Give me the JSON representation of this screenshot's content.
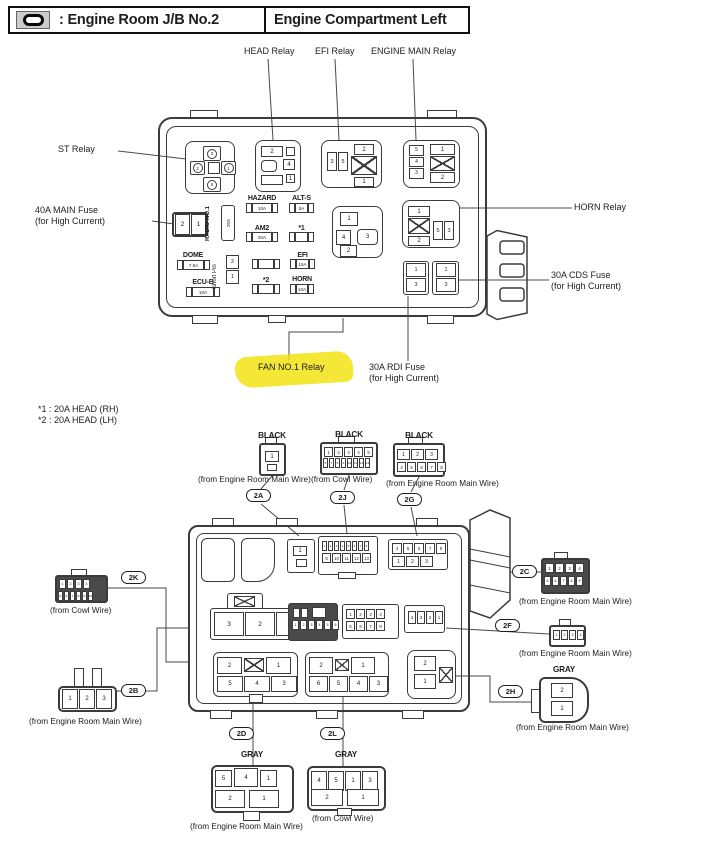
{
  "colors": {
    "highlight": "#f1e20a",
    "ink": "#3b3b3b"
  },
  "header": {
    "legend": ": Engine Room J/B No.2",
    "location": "Engine Compartment Left"
  },
  "notes": [
    "*1 : 20A HEAD (RH)",
    "*2 : 20A HEAD (LH)"
  ],
  "top": {
    "callouts": {
      "head": "HEAD Relay",
      "efi": "EFI Relay",
      "engine_main": "ENGINE MAIN Relay",
      "st": "ST Relay",
      "horn": "HORN Relay",
      "fan": "FAN NO.1 Relay",
      "main_fuse": [
        "40A MAIN Fuse",
        "(for High Current)"
      ],
      "cds_fuse": [
        "30A CDS Fuse",
        "(for High Current)"
      ],
      "rdi_fuse": [
        "30A RDI Fuse",
        "(for High Current)"
      ]
    },
    "fuses": {
      "hazard": {
        "label": "HAZARD",
        "rating": "10A"
      },
      "alt_s": {
        "label": "ALT-S",
        "rating": "5A"
      },
      "am2": {
        "label": "AM2",
        "rating": "30A"
      },
      "star1": {
        "label": "*1",
        "rating": ""
      },
      "dome": {
        "label": "DOME",
        "rating": "7.5A"
      },
      "efi": {
        "label": "EFI",
        "rating": "15A"
      },
      "ecu_b": {
        "label": "ECU-B",
        "rating": "10A"
      },
      "star2": {
        "label": "*2",
        "rating": ""
      },
      "horn": {
        "label": "HORN",
        "rating": "10A"
      },
      "radio": {
        "label": "RADIO NO.1",
        "rating": "20A"
      },
      "short_pin": {
        "label": "Short Pin",
        "pins": [
          "2",
          "1"
        ]
      }
    },
    "relays": {
      "st": {
        "top": "3",
        "left": "2",
        "right": "1",
        "bottom": "5"
      },
      "head": {
        "c1": "2",
        "c2": "4",
        "c3": "1"
      },
      "efi": {
        "pair": [
          "3",
          "5"
        ],
        "top": "2",
        "bottom": "1"
      },
      "engine_main": {
        "col": [
          "5",
          "4",
          "3"
        ],
        "top": "1",
        "bottom": "2"
      },
      "horn": {
        "top": "1",
        "bottom": "2",
        "pair": [
          "5",
          "3"
        ]
      },
      "fan": {
        "top": "1",
        "left": "4",
        "right": "3",
        "bottom": "2"
      },
      "main_fuse_cells": [
        "2",
        "1"
      ],
      "rdi_cells": [
        "1",
        "3"
      ],
      "cds_cells": [
        "1",
        "3"
      ]
    }
  },
  "bottom": {
    "c2a": {
      "id": "2A",
      "color": "BLACK",
      "from": "(from Engine Room Main Wire)"
    },
    "c2j": {
      "id": "2J",
      "color": "BLACK",
      "from": "(from Cowl Wire)"
    },
    "c2g": {
      "id": "2G",
      "color": "BLACK",
      "from": "(from Engine Room Main Wire)"
    },
    "c2k": {
      "id": "2K",
      "from": "(from Cowl Wire)"
    },
    "c2b": {
      "id": "2B",
      "from": "(from Engine Room Main Wire)"
    },
    "c2c": {
      "id": "2C",
      "from": "(from Engine Room Main Wire)"
    },
    "c2f": {
      "id": "2F",
      "from": "(from Engine Room Main Wire)"
    },
    "c2h": {
      "id": "2H",
      "color": "GRAY",
      "from": "(from Engine Room Main Wire)"
    },
    "c2d": {
      "id": "2D",
      "color": "GRAY",
      "from": "(from Engine Room Main Wire)"
    },
    "c2l": {
      "id": "2L",
      "color": "GRAY",
      "from": "(from Cowl Wire)"
    },
    "pins": {
      "p2a": [
        "1"
      ],
      "p2j_r1": [
        "1",
        "2",
        "3",
        "4",
        "5"
      ],
      "p2j_r2": [
        "6",
        "7",
        "8",
        "9",
        "10",
        "11",
        "12",
        "13"
      ],
      "p2g_r1": [
        "1",
        "2",
        "3"
      ],
      "p2g_r2": [
        "4",
        "5",
        "6",
        "7",
        "8"
      ],
      "p2k_r1": [
        "1",
        "2",
        "3",
        "4"
      ],
      "p2k_r2": [
        "5",
        "6",
        "7",
        "8",
        "9",
        "10"
      ],
      "p2b": [
        "1",
        "2",
        "3"
      ],
      "p2c_r1": [
        "1",
        "2",
        "3",
        "4"
      ],
      "p2c_r2": [
        "5",
        "6",
        "7",
        "8",
        "9"
      ],
      "p2f": [
        "1",
        "2",
        "3",
        "4"
      ],
      "p2h": [
        "2",
        "1"
      ],
      "p2d_r1": [
        "5",
        "4",
        "1"
      ],
      "p2d_r2": [
        "2",
        "1"
      ],
      "p2l_r1": [
        "4",
        "5",
        "1",
        "3"
      ],
      "p2l_r2": [
        "2",
        "1"
      ],
      "s2a": [
        "1"
      ],
      "s2j_r1": [
        "1",
        "2",
        "3",
        "4",
        "5",
        "6",
        "7",
        "8"
      ],
      "s2j_r2": [
        "9",
        "10",
        "11",
        "12",
        "13"
      ],
      "s2g_r1": [
        "4",
        "5",
        "6",
        "7",
        "8"
      ],
      "s2g_r2": [
        "1",
        "2",
        "3"
      ],
      "s2b": [
        "3",
        "2",
        "1"
      ],
      "s2k_r1": [
        "",
        ""
      ],
      "s2k_r2": [
        "1",
        "2",
        "3",
        "4",
        "5",
        "6"
      ],
      "s2c_r1": [
        "1",
        "2",
        "3",
        "4"
      ],
      "s2c_r2": [
        "5",
        "6",
        "7",
        "8"
      ],
      "s2f": [
        "4",
        "3",
        "2",
        "1"
      ],
      "s2d_row2": [
        "5",
        "4",
        "3"
      ],
      "s2l_row2": [
        "6",
        "5",
        "4",
        "3"
      ],
      "s2h": [
        "2",
        "1"
      ],
      "xcell_top_left": "2",
      "xcell_top_right": "1"
    }
  }
}
